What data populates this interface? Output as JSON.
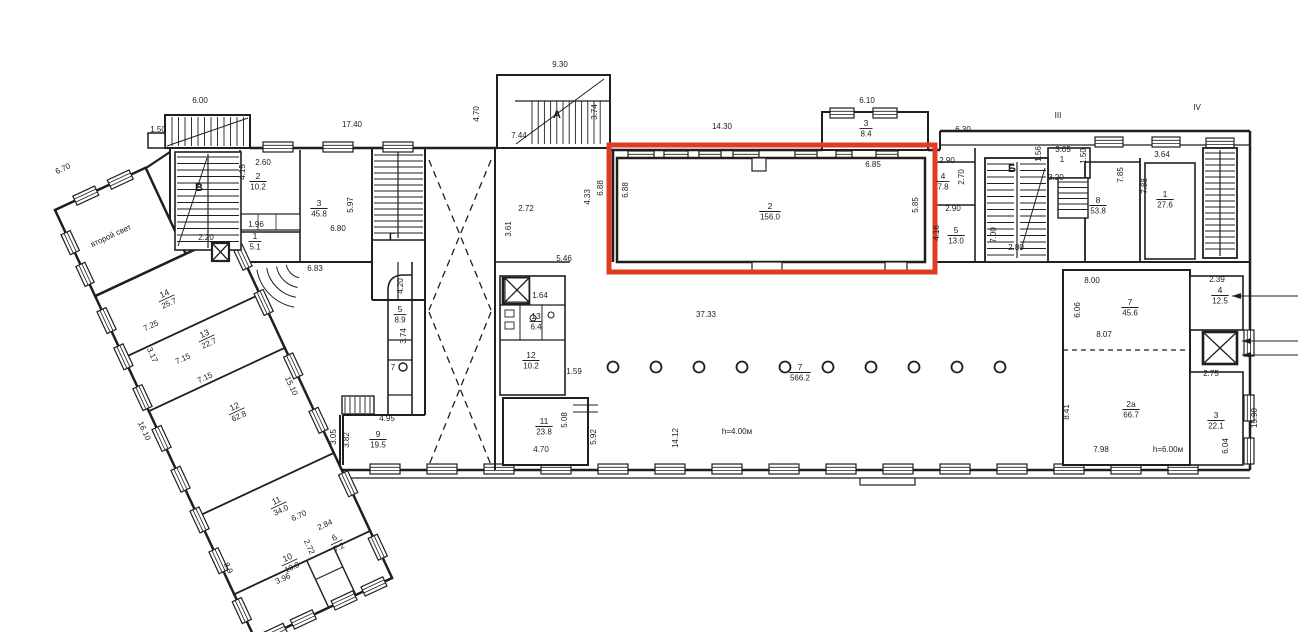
{
  "title": "floor-plan-with-highlight",
  "colors": {
    "ink": "#1f1f1f",
    "highlight": "#e23b22",
    "paper": "#ffffff"
  },
  "highlight_box": {
    "x": 609,
    "y": 145,
    "w": 326,
    "h": 127,
    "room": "2",
    "area": "156.0"
  },
  "notes": {
    "second_light": "второй свет",
    "height_hall": "h=4.00м",
    "height_right": "h=6.00м"
  },
  "stair_letters": [
    "А",
    "Б",
    "В",
    "Г"
  ],
  "section_marks": [
    "III",
    "IV"
  ],
  "rooms": [
    {
      "n": "2",
      "a": "10.2",
      "x": 258,
      "y": 180
    },
    {
      "n": "3",
      "a": "45.8",
      "x": 319,
      "y": 207
    },
    {
      "n": "1",
      "a": "5.1",
      "x": 255,
      "y": 240
    },
    {
      "n": "14",
      "a": "25.7",
      "x": 166,
      "y": 297,
      "r": -25
    },
    {
      "n": "13",
      "a": "22.7",
      "x": 206,
      "y": 337,
      "r": -25
    },
    {
      "n": "12",
      "a": "62.8",
      "x": 236,
      "y": 410,
      "r": -25
    },
    {
      "n": "11",
      "a": "34.0",
      "x": 278,
      "y": 504,
      "r": -25
    },
    {
      "n": "10",
      "a": "10.8",
      "x": 289,
      "y": 561,
      "r": -25
    },
    {
      "n": "6",
      "a": "7.2",
      "x": 336,
      "y": 541,
      "r": -25
    },
    {
      "n": "9",
      "a": "19.5",
      "x": 378,
      "y": 438
    },
    {
      "n": "5",
      "a": "8.9",
      "x": 400,
      "y": 313
    },
    {
      "n": "2",
      "a": "156.0",
      "x": 770,
      "y": 210
    },
    {
      "n": "3",
      "a": "8.4",
      "x": 866,
      "y": 127
    },
    {
      "n": "13",
      "a": "6.4",
      "x": 536,
      "y": 320
    },
    {
      "n": "12",
      "a": "10.2",
      "x": 531,
      "y": 359
    },
    {
      "n": "11",
      "a": "23.8",
      "x": 544,
      "y": 425
    },
    {
      "n": "7",
      "a": "566.2",
      "x": 800,
      "y": 371
    },
    {
      "n": "4",
      "a": "7.8",
      "x": 943,
      "y": 180
    },
    {
      "n": "5",
      "a": "13.0",
      "x": 956,
      "y": 234
    },
    {
      "n": "1",
      "a": "",
      "x": 1062,
      "y": 163
    },
    {
      "n": "8",
      "a": "53.8",
      "x": 1098,
      "y": 204
    },
    {
      "n": "1",
      "a": "27.6",
      "x": 1165,
      "y": 198
    },
    {
      "n": "7",
      "a": "45.6",
      "x": 1130,
      "y": 306
    },
    {
      "n": "2а",
      "a": "66.7",
      "x": 1131,
      "y": 408
    },
    {
      "n": "4",
      "a": "12.5",
      "x": 1220,
      "y": 294
    },
    {
      "n": "3",
      "a": "22.1",
      "x": 1216,
      "y": 419
    }
  ],
  "labels": [
    {
      "t": "6.00",
      "x": 200,
      "y": 103
    },
    {
      "t": "1.50",
      "x": 158,
      "y": 132
    },
    {
      "t": "17.40",
      "x": 352,
      "y": 127
    },
    {
      "t": "9.30",
      "x": 560,
      "y": 67
    },
    {
      "t": "4.70",
      "x": 479,
      "y": 114,
      "r": -90
    },
    {
      "t": "7.44",
      "x": 519,
      "y": 138
    },
    {
      "t": "3.74",
      "x": 597,
      "y": 112,
      "r": -90
    },
    {
      "t": "14.30",
      "x": 722,
      "y": 129
    },
    {
      "t": "6.10",
      "x": 867,
      "y": 103
    },
    {
      "t": "6.30",
      "x": 963,
      "y": 132
    },
    {
      "t": "2.60",
      "x": 263,
      "y": 165
    },
    {
      "t": "4.15",
      "x": 245,
      "y": 172,
      "r": -90
    },
    {
      "t": "5.97",
      "x": 353,
      "y": 205,
      "r": -90
    },
    {
      "t": "6.80",
      "x": 338,
      "y": 231
    },
    {
      "t": "1.96",
      "x": 256,
      "y": 227
    },
    {
      "t": "2.20",
      "x": 206,
      "y": 240
    },
    {
      "t": "6.83",
      "x": 315,
      "y": 271
    },
    {
      "t": "6.70",
      "x": 64,
      "y": 171,
      "r": -25
    },
    {
      "t": "7.25",
      "x": 152,
      "y": 328,
      "r": -25
    },
    {
      "t": "3.17",
      "x": 150,
      "y": 356,
      "r": 65
    },
    {
      "t": "7.15",
      "x": 184,
      "y": 361,
      "r": -25
    },
    {
      "t": "7.15",
      "x": 206,
      "y": 380,
      "r": -25
    },
    {
      "t": "15.10",
      "x": 289,
      "y": 387,
      "r": 65
    },
    {
      "t": "16.10",
      "x": 142,
      "y": 432,
      "r": 65
    },
    {
      "t": "6.70",
      "x": 300,
      "y": 518,
      "r": -25
    },
    {
      "t": "2.84",
      "x": 326,
      "y": 527,
      "r": -25
    },
    {
      "t": "3.96",
      "x": 284,
      "y": 581,
      "r": -25
    },
    {
      "t": "2.72",
      "x": 307,
      "y": 548,
      "r": 65
    },
    {
      "t": "8.9",
      "x": 226,
      "y": 569,
      "r": 65
    },
    {
      "t": "4.95",
      "x": 387,
      "y": 421
    },
    {
      "t": "3.05",
      "x": 336,
      "y": 437,
      "r": -90
    },
    {
      "t": "3.82",
      "x": 349,
      "y": 440,
      "r": -90
    },
    {
      "t": "4.20",
      "x": 403,
      "y": 286,
      "r": -90
    },
    {
      "t": "3.74",
      "x": 406,
      "y": 336,
      "r": -90
    },
    {
      "t": "7",
      "x": 393,
      "y": 370
    },
    {
      "t": "2.72",
      "x": 526,
      "y": 211
    },
    {
      "t": "3.61",
      "x": 511,
      "y": 229,
      "r": -90
    },
    {
      "t": "5.46",
      "x": 564,
      "y": 261
    },
    {
      "t": "4.33",
      "x": 590,
      "y": 197,
      "r": -90
    },
    {
      "t": "6.88",
      "x": 603,
      "y": 188,
      "r": -90
    },
    {
      "t": "6.88",
      "x": 628,
      "y": 190,
      "r": -90
    },
    {
      "t": "6.85",
      "x": 873,
      "y": 167
    },
    {
      "t": "5.85",
      "x": 918,
      "y": 205,
      "r": -90
    },
    {
      "t": "1.64",
      "x": 540,
      "y": 298
    },
    {
      "t": "1.59",
      "x": 574,
      "y": 374
    },
    {
      "t": "5.08",
      "x": 567,
      "y": 420,
      "r": -90
    },
    {
      "t": "4.70",
      "x": 541,
      "y": 452
    },
    {
      "t": "5.92",
      "x": 596,
      "y": 437,
      "r": -90
    },
    {
      "t": "37.33",
      "x": 706,
      "y": 317
    },
    {
      "t": "14.12",
      "x": 678,
      "y": 438,
      "r": -90
    },
    {
      "t": "h=4.00м",
      "x": 737,
      "y": 434
    },
    {
      "t": "2.90",
      "x": 947,
      "y": 163
    },
    {
      "t": "2.70",
      "x": 964,
      "y": 177,
      "r": -90
    },
    {
      "t": "2.90",
      "x": 953,
      "y": 211
    },
    {
      "t": "4.16",
      "x": 939,
      "y": 233,
      "r": -90
    },
    {
      "t": "7.00",
      "x": 996,
      "y": 235,
      "r": -90
    },
    {
      "t": "2.80",
      "x": 1016,
      "y": 250
    },
    {
      "t": "1.56",
      "x": 1041,
      "y": 154,
      "r": -90
    },
    {
      "t": "3.05",
      "x": 1063,
      "y": 152
    },
    {
      "t": "1.50",
      "x": 1086,
      "y": 156,
      "r": -90
    },
    {
      "t": "3.20",
      "x": 1056,
      "y": 180
    },
    {
      "t": "7.85",
      "x": 1123,
      "y": 175,
      "r": -90
    },
    {
      "t": "3.64",
      "x": 1162,
      "y": 157
    },
    {
      "t": "7.88",
      "x": 1147,
      "y": 186,
      "r": -90
    },
    {
      "t": "8.00",
      "x": 1092,
      "y": 283
    },
    {
      "t": "6.06",
      "x": 1080,
      "y": 310,
      "r": -90
    },
    {
      "t": "8.07",
      "x": 1104,
      "y": 337
    },
    {
      "t": "8.41",
      "x": 1069,
      "y": 412,
      "r": -90
    },
    {
      "t": "7.98",
      "x": 1101,
      "y": 452
    },
    {
      "t": "h=6.00м",
      "x": 1168,
      "y": 452
    },
    {
      "t": "2.39",
      "x": 1217,
      "y": 282
    },
    {
      "t": "2.75",
      "x": 1211,
      "y": 376
    },
    {
      "t": "6.04",
      "x": 1228,
      "y": 446,
      "r": -90
    },
    {
      "t": "15.90",
      "x": 1257,
      "y": 418,
      "r": -90
    },
    {
      "t": "А",
      "x": 557,
      "y": 118,
      "b": true
    },
    {
      "t": "Б",
      "x": 1012,
      "y": 172,
      "b": true
    },
    {
      "t": "В",
      "x": 199,
      "y": 191,
      "b": true
    },
    {
      "t": "Г",
      "x": 392,
      "y": 240,
      "b": true
    },
    {
      "t": "III",
      "x": 1058,
      "y": 118
    },
    {
      "t": "IV",
      "x": 1197,
      "y": 110
    },
    {
      "t": "второй свет",
      "x": 112,
      "y": 238,
      "r": -25
    }
  ]
}
